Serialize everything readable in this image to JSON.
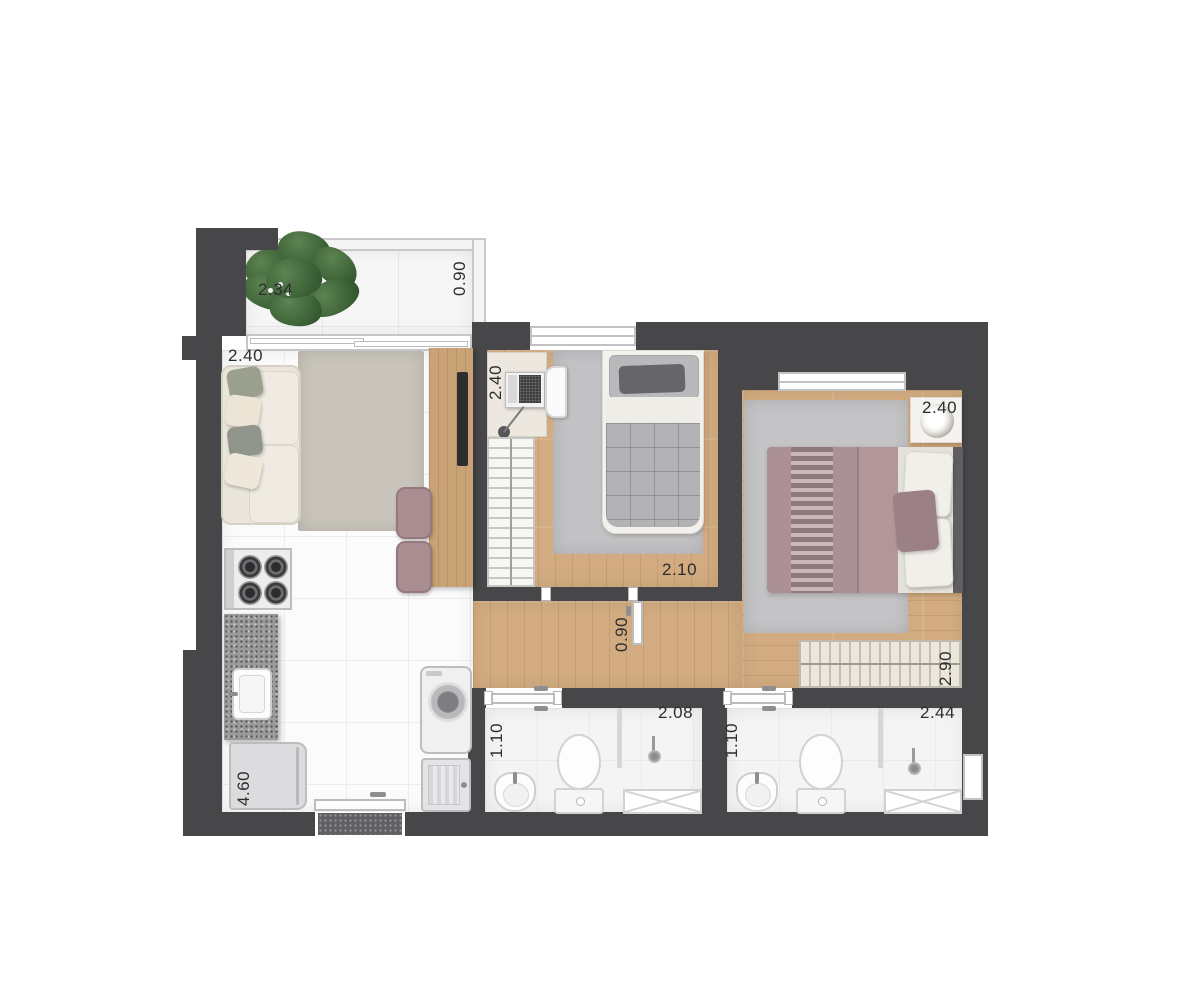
{
  "plan_type": "apartment-floor-plan",
  "labels": {
    "balcony_width": "2.34",
    "balcony_depth": "0.90",
    "living_width": "2.40",
    "bedroom1_width": "2.40",
    "bedroom1_length": "2.10",
    "hall_width": "0.90",
    "master_width": "2.40",
    "master_closet_length": "2.90",
    "bath1_width": "1.10",
    "bath1_length": "2.08",
    "bath2_width": "1.10",
    "bath2_length": "2.44",
    "kitchen_length": "4.60"
  },
  "colors": {
    "wall": "#47474a",
    "wood_floor": "#d2ab80",
    "tile_floor": "#fbfbfc",
    "rug_living": "#c8c4bb",
    "rug_bedroom": "#c2c2c4",
    "sofa": "#eae6dc",
    "double_bed": "#ab9195",
    "single_bed_blanket": "#b3b3b5",
    "accent_mauve": "#a88e91",
    "plant_green": "#3d6338",
    "granite": "#9b9b9d"
  }
}
